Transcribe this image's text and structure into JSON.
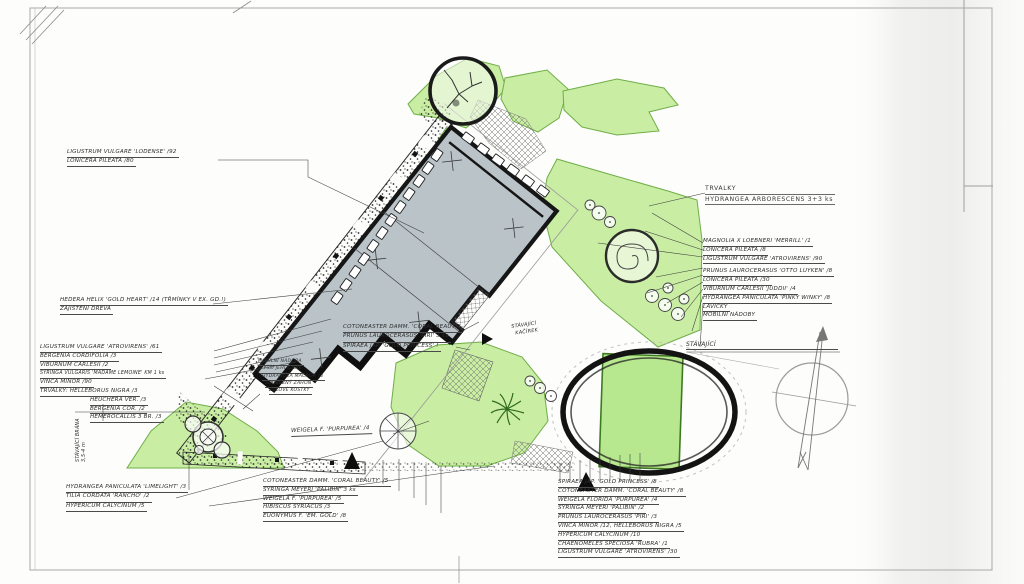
{
  "sheet_type": "hand-drawn garden landscape plan",
  "colors": {
    "paper": "#fdfdfc",
    "ink": "#1d1d1d",
    "pencil": "#9a9a9a",
    "green_light": "#c9eda3",
    "green_mid": "#b7e78e",
    "green_edge": "#6fae47",
    "building_fill": "#b9c3c8"
  },
  "labels": {
    "top_left": [
      "LIGUSTRUM VULGARE 'LODENSE' /92",
      "LONICERA PILEATA /80"
    ],
    "trvalky_header": {
      "title": "TRVALKY",
      "item": "HYDRANGEA ARBORESCENS 3+3 ks"
    },
    "right_list": [
      "MAGNOLIA X LOEBNERI 'MERRILL' /1",
      "LONICERA PILEATA /8",
      "LIGUSTRUM VULGARE 'ATROVIRENS' /90",
      "PRUNUS LAUROCERASUS 'OTTO LUYKEN' /8",
      "LONICERA PILEATA /30",
      "VIBURNUM CARLESII 'JUDDII' /4",
      "HYDRANGEA PANICULATA 'PINKY WINKY' /8",
      "LAVIČKY",
      "MOBILNÍ NÁDOBY"
    ],
    "left_list_1": [
      "HEDERA HELIX 'GOLD HEART' /14 (TŘMÍNKY V EX. GD.!)",
      "ZAJIŠTĚNÍ DŘEVA"
    ],
    "left_list_2": [
      "LIGUSTRUM VULGARE 'ATROVIRENS' /61",
      "BERGENIA CORDIFOLIA /3",
      "VIBURNUM CARLESII /2",
      "SYRINGA VULGARIS 'MADAME LEMOINE' KM 1 ks",
      "VINCA MINOR /90",
      "TRVALKY:  HELLEBORUS NIGRA /3",
      "HEUCHERA VER. /3",
      "BERGENIA COR. /2",
      "HEMEROCALLIS 3 BR. /3"
    ],
    "gate_note": [
      "STÁVAJÍCÍ BRÁNA",
      "3,5-4 m"
    ],
    "bottom_left_list": [
      "HYDRANGEA PANICULATA 'LIMELIGHT' /3",
      "TILIA CORDATA 'RANCHO' /2",
      "HYPERICUM CALYCINUM /5"
    ],
    "bottom_center_list": [
      "COTONEASTER DAMM. 'CORAL BEAUTY' /5",
      "SYRINGA MEYERI 'PALIBIN' 3 ks",
      "WEIGELA F. 'PURPUREA' /5",
      "HIBISCUS SYRIACUS /3",
      "EUONYMUS F. 'EM. GOLD' /8"
    ],
    "center_note": [
      "COTONEASTER DAMM. 'CORAL BEAUTY'",
      "PRUNUS LAUROCERASUS 'PIRI' 3 ks",
      "SPIRAEA JAP. 'GOLD PRINCESS' !"
    ],
    "container_note": [
      "MOBILNÍ NÁDOBA",
      "VYŠŠÍ JEHLIČŇÁK",
      "HYDRANGEA MACROP. /4",
      "SOUBĚŽNÝ ZÁHON",
      "ŽULOVÉ KOSTKY"
    ],
    "gravel_note": [
      "STÁVAJÍCÍ",
      "KAČÍREK"
    ],
    "existing_note": "STÁVAJÍCÍ",
    "bottom_right_list": [
      "SPIRAEA JAP. 'GOLD PRINCESS' /8",
      "COTONEASTER DAMM. 'CORAL BEAUTY' /8",
      "WEIGELA FLORIDA 'PURPUREA' /4",
      "SYRINGA MEYERI 'PALIBIN' /2",
      "PRUNUS LAUROCERASUS 'PIRI' /3",
      "VINCA MINOR /12, HELLEBORUS NIGRA /5",
      "HYPERICUM CALYCINUM /10",
      "CHAENOMELES SPECIOSA 'RUBRA' /1",
      "LIGUSTRUM VULGARE 'ATROVIRENS' /30"
    ],
    "weigela_note": "WEIGELA F. 'PURPUREA' /4"
  }
}
